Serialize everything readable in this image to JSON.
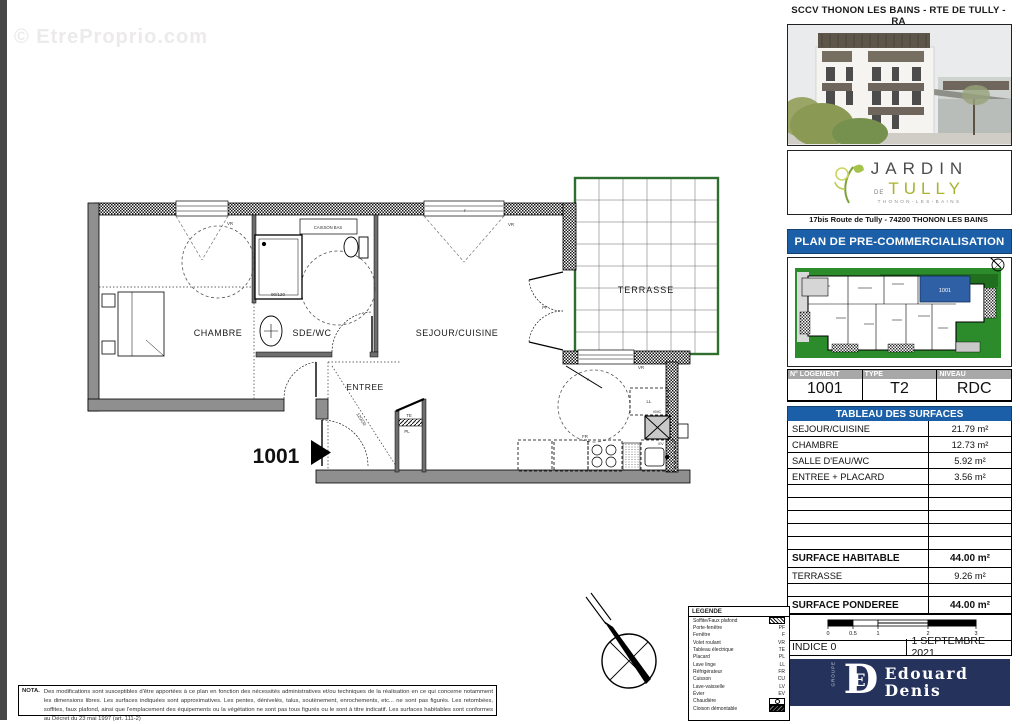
{
  "watermark": "© EtreProprio.com",
  "header": {
    "project_title": "SCCV THONON LES BAINS - RTE DE TULLY - RA"
  },
  "branding": {
    "logo_line1": "JARDIN",
    "logo_de": "DE",
    "logo_line2": "TULLY",
    "logo_sub": "THONON-LES-BAINS",
    "address": "17bis Route de Tully - 74200 THONON LES BAINS"
  },
  "banner": {
    "label": "PLAN DE PRE-COMMERCIALISATION"
  },
  "siteplan": {
    "unit_label": "1001"
  },
  "unit_table": {
    "headers": [
      "N° LOGEMENT",
      "TYPE",
      "NIVEAU"
    ],
    "values": [
      "1001",
      "T2",
      "RDC"
    ]
  },
  "surface_table": {
    "title": "TABLEAU DES SURFACES",
    "rows": [
      {
        "kind": "data",
        "label": "SEJOUR/CUISINE",
        "value": "21.79 m²"
      },
      {
        "kind": "data",
        "label": "CHAMBRE",
        "value": "12.73 m²"
      },
      {
        "kind": "data",
        "label": "SALLE D'EAU/WC",
        "value": "5.92 m²"
      },
      {
        "kind": "data",
        "label": "ENTREE + PLACARD",
        "value": "3.56 m²"
      },
      {
        "kind": "empty",
        "label": "",
        "value": ""
      },
      {
        "kind": "empty",
        "label": "",
        "value": ""
      },
      {
        "kind": "empty",
        "label": "",
        "value": ""
      },
      {
        "kind": "empty",
        "label": "",
        "value": ""
      },
      {
        "kind": "empty",
        "label": "",
        "value": ""
      },
      {
        "kind": "bold",
        "label": "SURFACE HABITABLE",
        "value": "44.00 m²"
      },
      {
        "kind": "data",
        "label": "TERRASSE",
        "value": "9.26 m²"
      },
      {
        "kind": "empty",
        "label": "",
        "value": ""
      },
      {
        "kind": "bold",
        "label": "SURFACE PONDEREE",
        "value": "44.00 m²"
      }
    ]
  },
  "scalebar": {
    "ticks": [
      "0",
      "0.5",
      "1",
      "2",
      "3"
    ]
  },
  "revision": {
    "indice": "INDICE 0",
    "date": "1 SEPTEMBRE 2021"
  },
  "developer": {
    "group": "GROUPE",
    "monogram": "D",
    "monogram_inner": "E",
    "name_line1": "Edouard",
    "name_line2": "Denis"
  },
  "floorplan": {
    "unit_number": "1001",
    "rooms": {
      "chambre": "CHAMBRE",
      "sde": "SDE/WC",
      "sejour": "SEJOUR/CUISINE",
      "entree": "ENTREE",
      "terrasse": "TERRASSE"
    },
    "annotations": {
      "caisson": "CAISSON BAS",
      "shower_dim": "90/120",
      "placard_dim": "120/20",
      "te": "TE",
      "pl": "PL",
      "ll": "LL",
      "fr": "FR",
      "ev": "EV",
      "vmc": "VMC",
      "pf": "PF",
      "vr": "VR",
      "f": "F",
      "p": "P"
    }
  },
  "legend": {
    "title": "LEGENDE",
    "items": [
      {
        "label": "Soffite/Faux plafond",
        "abbr": "",
        "swatch": "hatch"
      },
      {
        "label": "Porte-fenêtre",
        "abbr": "PF",
        "swatch": ""
      },
      {
        "label": "Fenêtre",
        "abbr": "F",
        "swatch": ""
      },
      {
        "label": "Volet roulant",
        "abbr": "VR",
        "swatch": ""
      },
      {
        "label": "Tableau électrique",
        "abbr": "TE",
        "swatch": ""
      },
      {
        "label": "Placard",
        "abbr": "PL",
        "swatch": ""
      },
      {
        "label": "Lave linge",
        "abbr": "LL",
        "swatch": ""
      },
      {
        "label": "Réfrigérateur",
        "abbr": "FR",
        "swatch": ""
      },
      {
        "label": "Cuisson",
        "abbr": "CU",
        "swatch": ""
      },
      {
        "label": "Lave-vaisselle",
        "abbr": "LV",
        "swatch": ""
      },
      {
        "label": "Évier",
        "abbr": "EV",
        "swatch": ""
      },
      {
        "label": "Chaudière",
        "abbr": "",
        "swatch": "boiler"
      },
      {
        "label": "Cloison démontable",
        "abbr": "",
        "swatch": "solid"
      }
    ]
  },
  "nota": {
    "label": "NOTA.",
    "text": "Des modifications sont susceptibles d'être apportées à ce plan en fonction des nécessités administratives et/ou techniques de la réalisation en ce qui concerne notamment les dimensions libres. Les surfaces indiquées sont approximatives. Les pentes, dénivelés, talus, soutènement, enrochements, etc... ne sont pas figurés. Les retombées, soffites, faux plafond, ainsi que l'emplacement des équipements ou la végétation ne sont pas tous figurés ou le sont à titre indicatif. Les surfaces habitables sont conformes au Décret du 23 mai 1997 (art. 111-2)"
  },
  "colors": {
    "accent_blue": "#1b5fa8",
    "navy": "#25335c",
    "site_green": "#2c8c2c",
    "terrace_green": "#2e6e2e",
    "unit_blue": "#2f5fa5",
    "wall_gray": "#8f8f8f"
  }
}
